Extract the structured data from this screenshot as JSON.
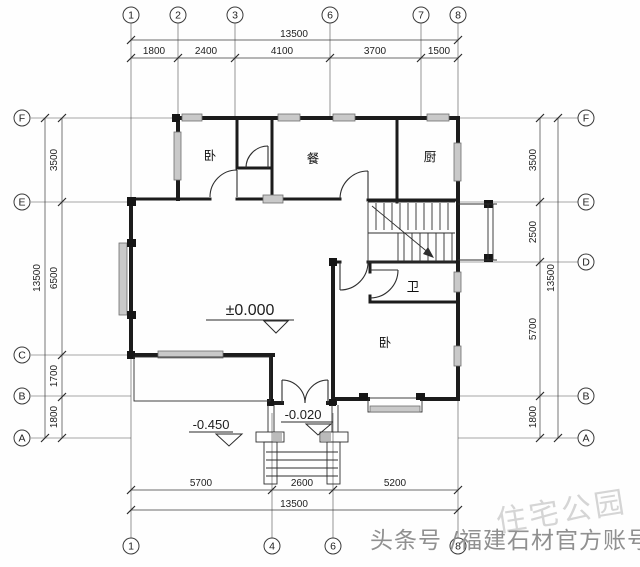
{
  "axis_bubbles": {
    "top": [
      "1",
      "2",
      "3",
      "6",
      "7",
      "8"
    ],
    "bottom": [
      "1",
      "4",
      "6",
      "8"
    ],
    "left": [
      "F",
      "E",
      "C",
      "B",
      "A"
    ],
    "right": [
      "F",
      "E",
      "D",
      "B",
      "A"
    ]
  },
  "dimensions": {
    "top": {
      "total": "13500",
      "segments": [
        "1800",
        "2400",
        "4100",
        "3700",
        "1500"
      ]
    },
    "bottom": {
      "total": "13500",
      "segments": [
        "5700",
        "2600",
        "5200"
      ]
    },
    "left": {
      "total": "13500",
      "segments": [
        "3500",
        "6500",
        "1700",
        "1800"
      ]
    },
    "right": {
      "total": "13500",
      "segments": [
        "3500",
        "2500",
        "5700",
        "1800"
      ]
    }
  },
  "rooms": {
    "bedroom_upper": "卧",
    "dining": "餐",
    "kitchen": "厨",
    "bathroom": "卫",
    "bedroom_lower": "卧"
  },
  "levels": {
    "floor": "±0.000",
    "ground": "-0.450",
    "entry": "-0.020"
  },
  "watermarks": {
    "brand": "住宅公园",
    "account": "头条号 /福建石材官方账号"
  },
  "colors": {
    "wall": "#1c1c1c",
    "grid": "#4f4f4f",
    "window_fill": "#c9c9c9",
    "watermark_dark": "#909090",
    "watermark_light": "#d5d5d5",
    "background": "#fefefe"
  }
}
